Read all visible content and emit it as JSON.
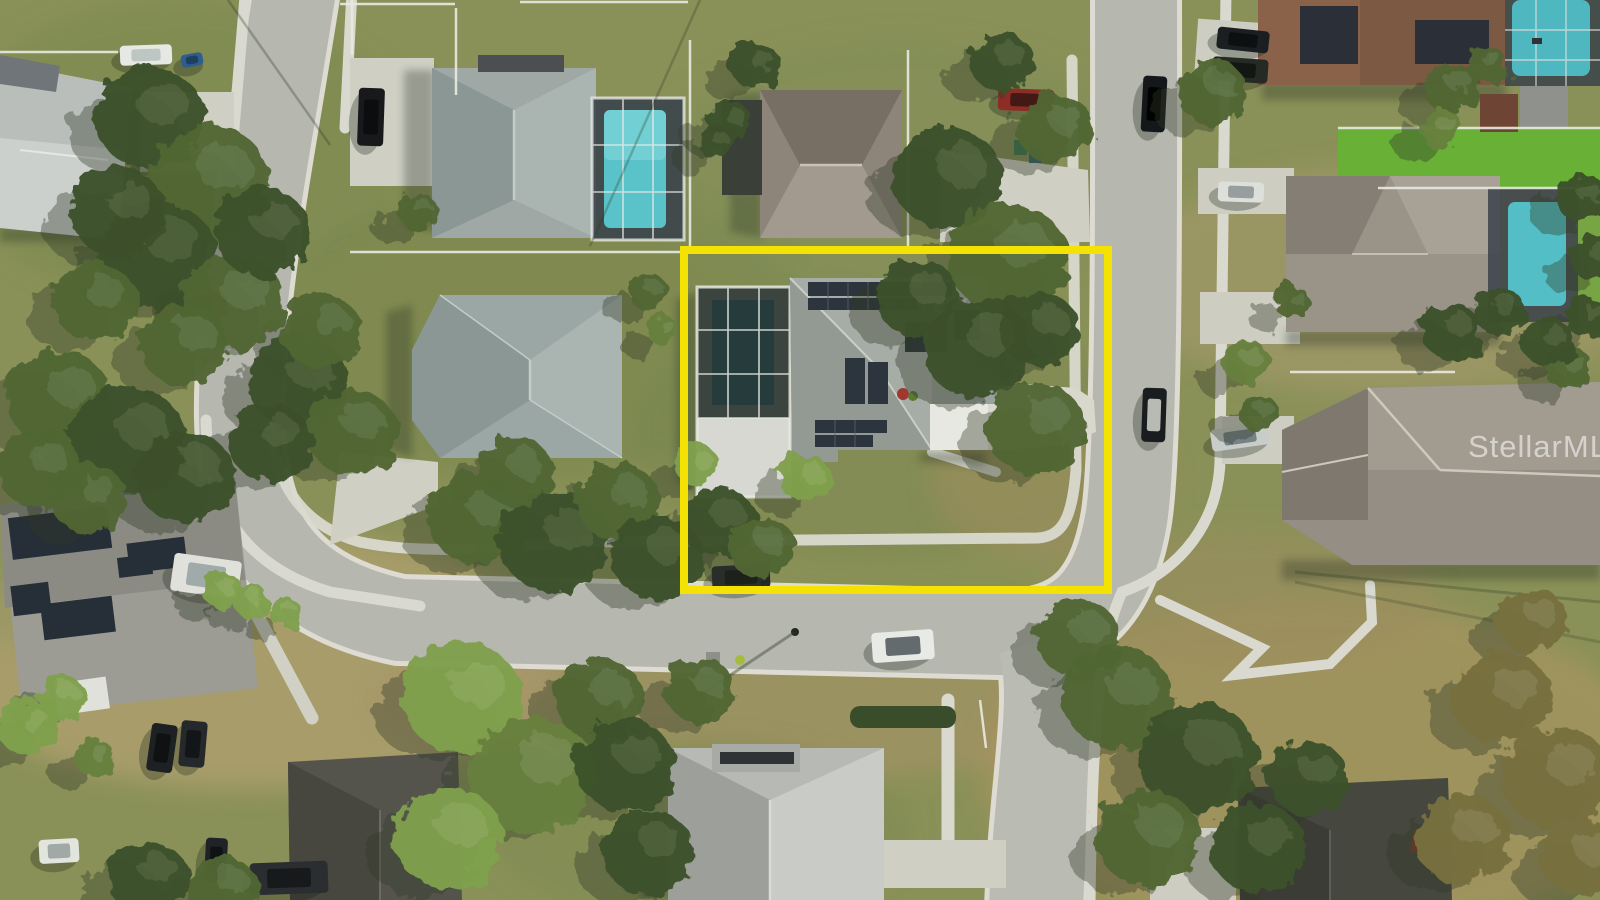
{
  "scene": {
    "type": "aerial-drone-photograph",
    "setting": "Suburban residential neighborhood of single-family homes with curving streets, lawns, large oak trees and screened pool enclosures",
    "highlighted_property": {
      "description": "Corner-lot single-family home with gray shingle roof, rooftop solar panels, screened pool enclosure and concrete driveway, outlined in yellow",
      "features": [
        "solar-panels",
        "screened-pool-enclosure",
        "concrete-driveway",
        "corner-lot",
        "street-frontage"
      ]
    },
    "watermark": {
      "text": "StellarMLS",
      "color": "#ffffff",
      "opacity": 0.55
    },
    "highlight_box": {
      "x": 684,
      "y": 250,
      "width": 424,
      "height": 340,
      "color": "#F4E204",
      "stroke_width": 8
    },
    "palette": {
      "road": "#b6b7af",
      "road_sunlit": "#c2c3bb",
      "curb": "#dedcd2",
      "sidewalk": "#d9d9cf",
      "concrete": "#d5d5c9",
      "grass_green": "#7a8850",
      "grass_dry": "#ab9a6c",
      "turf_bright": "#68b036",
      "pool_water": "#5ac3c9",
      "solar_panel": "#2c343d",
      "roof_gray": "#9aa09b",
      "roof_blue_gray": "#9aa7a5",
      "roof_taupe": "#8d857a",
      "roof_brown": "#7c5942",
      "roof_light": "#ccd0cd",
      "roof_dark": "#46473f",
      "tree_dark": "#3c5129",
      "tree_mid": "#4f6634",
      "tree_light": "#68803e",
      "tree_bright": "#7fa04b",
      "tree_olive": "#77713f",
      "shadow": "#2c3a22",
      "highlight_yellow": "#F4E204"
    },
    "tones": {
      "d": "#3c5129",
      "m": "#4f6634",
      "l": "#68803e",
      "b": "#7fa04b",
      "o": "#77713f"
    },
    "trees": [
      {
        "x": 150,
        "y": 118,
        "r": 55,
        "tone": "d"
      },
      {
        "x": 208,
        "y": 182,
        "r": 62,
        "tone": "m"
      },
      {
        "x": 158,
        "y": 255,
        "r": 58,
        "tone": "d"
      },
      {
        "x": 232,
        "y": 302,
        "r": 52,
        "tone": "m"
      },
      {
        "x": 118,
        "y": 212,
        "r": 48,
        "tone": "d"
      },
      {
        "x": 95,
        "y": 302,
        "r": 42,
        "tone": "m"
      },
      {
        "x": 262,
        "y": 232,
        "r": 48,
        "tone": "d"
      },
      {
        "x": 185,
        "y": 345,
        "r": 45,
        "tone": "m"
      },
      {
        "x": 58,
        "y": 398,
        "r": 52,
        "tone": "m"
      },
      {
        "x": 128,
        "y": 440,
        "r": 58,
        "tone": "d"
      },
      {
        "x": 38,
        "y": 468,
        "r": 42,
        "tone": "m"
      },
      {
        "x": 186,
        "y": 478,
        "r": 50,
        "tone": "d"
      },
      {
        "x": 88,
        "y": 498,
        "r": 38,
        "tone": "m"
      },
      {
        "x": 298,
        "y": 382,
        "r": 50,
        "tone": "d"
      },
      {
        "x": 352,
        "y": 432,
        "r": 46,
        "tone": "m"
      },
      {
        "x": 270,
        "y": 442,
        "r": 42,
        "tone": "d"
      },
      {
        "x": 320,
        "y": 330,
        "r": 40,
        "tone": "m"
      },
      {
        "x": 418,
        "y": 212,
        "r": 20,
        "tone": "m"
      },
      {
        "x": 222,
        "y": 590,
        "r": 20,
        "tone": "b"
      },
      {
        "x": 252,
        "y": 602,
        "r": 18,
        "tone": "b"
      },
      {
        "x": 285,
        "y": 612,
        "r": 16,
        "tone": "b"
      },
      {
        "x": 478,
        "y": 518,
        "r": 50,
        "tone": "m"
      },
      {
        "x": 555,
        "y": 542,
        "r": 55,
        "tone": "d"
      },
      {
        "x": 618,
        "y": 502,
        "r": 42,
        "tone": "m"
      },
      {
        "x": 658,
        "y": 558,
        "r": 46,
        "tone": "d"
      },
      {
        "x": 515,
        "y": 472,
        "r": 38,
        "tone": "m"
      },
      {
        "x": 718,
        "y": 522,
        "r": 38,
        "tone": "d"
      },
      {
        "x": 762,
        "y": 548,
        "r": 34,
        "tone": "m"
      },
      {
        "x": 805,
        "y": 478,
        "r": 26,
        "tone": "b"
      },
      {
        "x": 697,
        "y": 465,
        "r": 22,
        "tone": "b"
      },
      {
        "x": 462,
        "y": 698,
        "r": 60,
        "tone": "b"
      },
      {
        "x": 532,
        "y": 775,
        "r": 64,
        "tone": "l"
      },
      {
        "x": 448,
        "y": 838,
        "r": 55,
        "tone": "b"
      },
      {
        "x": 600,
        "y": 700,
        "r": 45,
        "tone": "m"
      },
      {
        "x": 625,
        "y": 765,
        "r": 50,
        "tone": "d"
      },
      {
        "x": 648,
        "y": 852,
        "r": 46,
        "tone": "d"
      },
      {
        "x": 700,
        "y": 690,
        "r": 35,
        "tone": "m"
      },
      {
        "x": 948,
        "y": 178,
        "r": 55,
        "tone": "d"
      },
      {
        "x": 1008,
        "y": 258,
        "r": 60,
        "tone": "m"
      },
      {
        "x": 978,
        "y": 348,
        "r": 55,
        "tone": "d"
      },
      {
        "x": 1035,
        "y": 428,
        "r": 50,
        "tone": "m"
      },
      {
        "x": 918,
        "y": 298,
        "r": 42,
        "tone": "d"
      },
      {
        "x": 1055,
        "y": 128,
        "r": 38,
        "tone": "m"
      },
      {
        "x": 1002,
        "y": 62,
        "r": 32,
        "tone": "d"
      },
      {
        "x": 1040,
        "y": 330,
        "r": 40,
        "tone": "d"
      },
      {
        "x": 755,
        "y": 65,
        "r": 25,
        "tone": "d"
      },
      {
        "x": 730,
        "y": 122,
        "r": 22,
        "tone": "d"
      },
      {
        "x": 648,
        "y": 292,
        "r": 20,
        "tone": "m"
      },
      {
        "x": 663,
        "y": 330,
        "r": 16,
        "tone": "l"
      },
      {
        "x": 1212,
        "y": 92,
        "r": 35,
        "tone": "m"
      },
      {
        "x": 1246,
        "y": 362,
        "r": 24,
        "tone": "l"
      },
      {
        "x": 1258,
        "y": 412,
        "r": 20,
        "tone": "m"
      },
      {
        "x": 1292,
        "y": 302,
        "r": 18,
        "tone": "m"
      },
      {
        "x": 1452,
        "y": 88,
        "r": 28,
        "tone": "m"
      },
      {
        "x": 1440,
        "y": 128,
        "r": 22,
        "tone": "l"
      },
      {
        "x": 1488,
        "y": 65,
        "r": 20,
        "tone": "m"
      },
      {
        "x": 1582,
        "y": 198,
        "r": 26,
        "tone": "d"
      },
      {
        "x": 1594,
        "y": 258,
        "r": 24,
        "tone": "d"
      },
      {
        "x": 1588,
        "y": 318,
        "r": 22,
        "tone": "d"
      },
      {
        "x": 1568,
        "y": 368,
        "r": 24,
        "tone": "m"
      },
      {
        "x": 1452,
        "y": 332,
        "r": 30,
        "tone": "d"
      },
      {
        "x": 1500,
        "y": 312,
        "r": 26,
        "tone": "d"
      },
      {
        "x": 1548,
        "y": 342,
        "r": 26,
        "tone": "d"
      },
      {
        "x": 1118,
        "y": 698,
        "r": 55,
        "tone": "m"
      },
      {
        "x": 1198,
        "y": 758,
        "r": 60,
        "tone": "d"
      },
      {
        "x": 1148,
        "y": 838,
        "r": 52,
        "tone": "m"
      },
      {
        "x": 1258,
        "y": 848,
        "r": 48,
        "tone": "d"
      },
      {
        "x": 1078,
        "y": 638,
        "r": 42,
        "tone": "m"
      },
      {
        "x": 1308,
        "y": 778,
        "r": 40,
        "tone": "d"
      },
      {
        "x": 1502,
        "y": 698,
        "r": 50,
        "tone": "o"
      },
      {
        "x": 1558,
        "y": 778,
        "r": 55,
        "tone": "o"
      },
      {
        "x": 1462,
        "y": 838,
        "r": 48,
        "tone": "o"
      },
      {
        "x": 1582,
        "y": 858,
        "r": 42,
        "tone": "o"
      },
      {
        "x": 1532,
        "y": 620,
        "r": 35,
        "tone": "o"
      },
      {
        "x": 28,
        "y": 728,
        "r": 30,
        "tone": "b"
      },
      {
        "x": 62,
        "y": 698,
        "r": 24,
        "tone": "b"
      },
      {
        "x": 148,
        "y": 878,
        "r": 40,
        "tone": "d"
      },
      {
        "x": 222,
        "y": 888,
        "r": 35,
        "tone": "m"
      },
      {
        "x": 95,
        "y": 758,
        "r": 20,
        "tone": "l"
      },
      {
        "x": 715,
        "y": 142,
        "r": 18,
        "tone": "d"
      }
    ],
    "vehicles": [
      {
        "name": "white-pickup-on-road",
        "x": 903,
        "y": 646,
        "w": 62,
        "h": 30,
        "angle": -4,
        "body": "#e8eae6",
        "glass": "#555d60"
      },
      {
        "name": "dark-suv-parked-street",
        "x": 741,
        "y": 577,
        "w": 58,
        "h": 24,
        "angle": -3,
        "body": "#23272a",
        "glass": "#101214"
      },
      {
        "name": "black-suv-on-north-street",
        "x": 1154,
        "y": 104,
        "w": 24,
        "h": 56,
        "angle": 3,
        "body": "#15181a",
        "glass": "#000000"
      },
      {
        "name": "red-sedan-driveway",
        "x": 1026,
        "y": 100,
        "w": 56,
        "h": 22,
        "angle": 2,
        "body": "#8e2d26",
        "glass": "#3a1714"
      },
      {
        "name": "red-pickup-left-driveway",
        "x": 194,
        "y": 305,
        "w": 66,
        "h": 24,
        "angle": -2,
        "body": "#8f241f",
        "glass": "#2a0f0d"
      },
      {
        "name": "white-box-truck-left",
        "x": 206,
        "y": 576,
        "w": 68,
        "h": 38,
        "angle": 8,
        "body": "#dfe1da",
        "glass": "#9aa4a4"
      },
      {
        "name": "dark-suv-top-right-1",
        "x": 1243,
        "y": 40,
        "w": 52,
        "h": 22,
        "angle": 6,
        "body": "#1c1f22",
        "glass": "#0c0e10"
      },
      {
        "name": "dark-truck-top-right-2",
        "x": 1240,
        "y": 70,
        "w": 56,
        "h": 24,
        "angle": 4,
        "body": "#252a24",
        "glass": "#121512"
      },
      {
        "name": "white-sedan-right-driveway",
        "x": 1241,
        "y": 192,
        "w": 46,
        "h": 20,
        "angle": 2,
        "body": "#dcdfda",
        "glass": "#8e9896"
      },
      {
        "name": "golf-cart-on-road",
        "x": 1154,
        "y": 415,
        "w": 24,
        "h": 54,
        "angle": 2,
        "body": "#1a1d1f",
        "glass": "#caccc4"
      },
      {
        "name": "boat-on-trailer",
        "x": 1240,
        "y": 437,
        "w": 58,
        "h": 22,
        "angle": -8,
        "body": "#c8cdc9",
        "glass": "#6e7a7e"
      },
      {
        "name": "dark-suv-bottom-left-1",
        "x": 162,
        "y": 748,
        "w": 26,
        "h": 48,
        "angle": 8,
        "body": "#1e2124",
        "glass": "#0d0f11"
      },
      {
        "name": "dark-suv-bottom-left-2",
        "x": 193,
        "y": 744,
        "w": 26,
        "h": 46,
        "angle": 5,
        "body": "#26292c",
        "glass": "#121416"
      },
      {
        "name": "dark-sedan-bottom-left-3",
        "x": 216,
        "y": 860,
        "w": 22,
        "h": 44,
        "angle": 3,
        "body": "#202326",
        "glass": "#0e1012"
      },
      {
        "name": "dark-wagon-bottom",
        "x": 289,
        "y": 878,
        "w": 78,
        "h": 32,
        "angle": -2,
        "body": "#2b2e30",
        "glass": "#151718"
      },
      {
        "name": "white-car-bottom-left",
        "x": 59,
        "y": 851,
        "w": 40,
        "h": 24,
        "angle": -3,
        "body": "#e2e4de",
        "glass": "#9aa2a0"
      },
      {
        "name": "black-suv-house2-driveway",
        "x": 371,
        "y": 117,
        "w": 26,
        "h": 58,
        "angle": 2,
        "body": "#17191b",
        "glass": "#0a0c0d"
      },
      {
        "name": "white-trailer-top-left",
        "x": 146,
        "y": 55,
        "w": 52,
        "h": 20,
        "angle": -2,
        "body": "#e6e8e3",
        "glass": "#b9c2c0"
      },
      {
        "name": "blue-jetski-top-left",
        "x": 192,
        "y": 60,
        "w": 22,
        "h": 13,
        "angle": -10,
        "body": "#2e5e8e",
        "glass": "#1d3c5c"
      }
    ]
  }
}
